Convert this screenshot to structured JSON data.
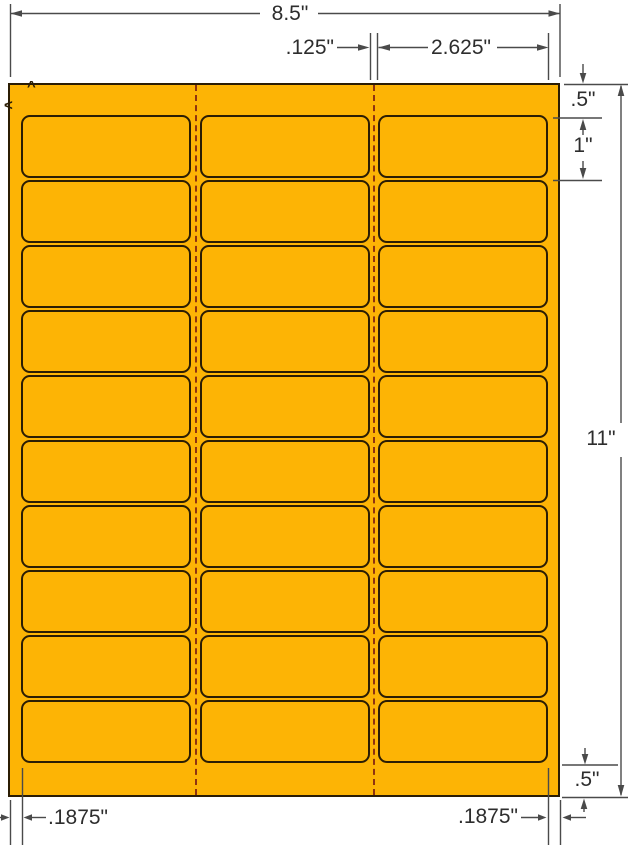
{
  "diagram": {
    "sheet": {
      "columns": 3,
      "rows": 10,
      "fill": "#FDB405",
      "outline": "#2B1D04",
      "dash_color": "#8F3310",
      "dimension_line_color": "#4a4a4a"
    },
    "marks": {
      "up": "^",
      "left": "<"
    },
    "dims": {
      "page_width": "8.5\"",
      "gutter": ".125\"",
      "label_width": "2.625\"",
      "top_margin": ".5\"",
      "label_height": "1\"",
      "page_height": "11\"",
      "bottom_margin": ".5\"",
      "left_margin": ".1875\"",
      "right_margin": ".1875\""
    }
  }
}
